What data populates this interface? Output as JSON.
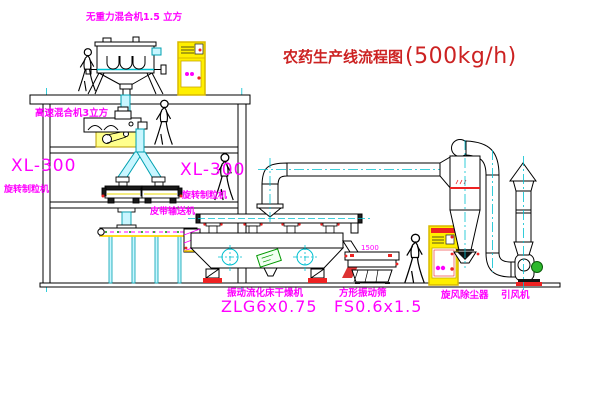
{
  "diagram": {
    "title": {
      "main": "农药生产线流程图",
      "capacity": "(500kg/h)"
    },
    "labels": {
      "gravityless_mixer": "无重力混合机1.5 立方",
      "high_speed_mixer": "高速混合机3立方",
      "granulator_left_model": "XL-300",
      "granulator_left_name": "旋转制粒机",
      "granulator_mid_model": "XL-300",
      "granulator_mid_name": "旋转制粒机",
      "belt_conveyor": "皮带输送机",
      "dryer_name": "振动流化床干燥机",
      "dryer_model": "ZLG6x0.75",
      "sieve_name": "方形振动筛",
      "sieve_model": "FS0.6x1.5",
      "sieve_dimension": "1500",
      "cyclone_name": "旋风除尘器",
      "fan_name": "引风机"
    },
    "colors": {
      "label_magenta": "#ff00ff",
      "title_red": "#cc2222",
      "pipe_cyan": "#00c0d0",
      "cabinet_yellow": "#ffef00",
      "accent_red": "#ee2222",
      "motor_green": "#2db82d"
    }
  }
}
